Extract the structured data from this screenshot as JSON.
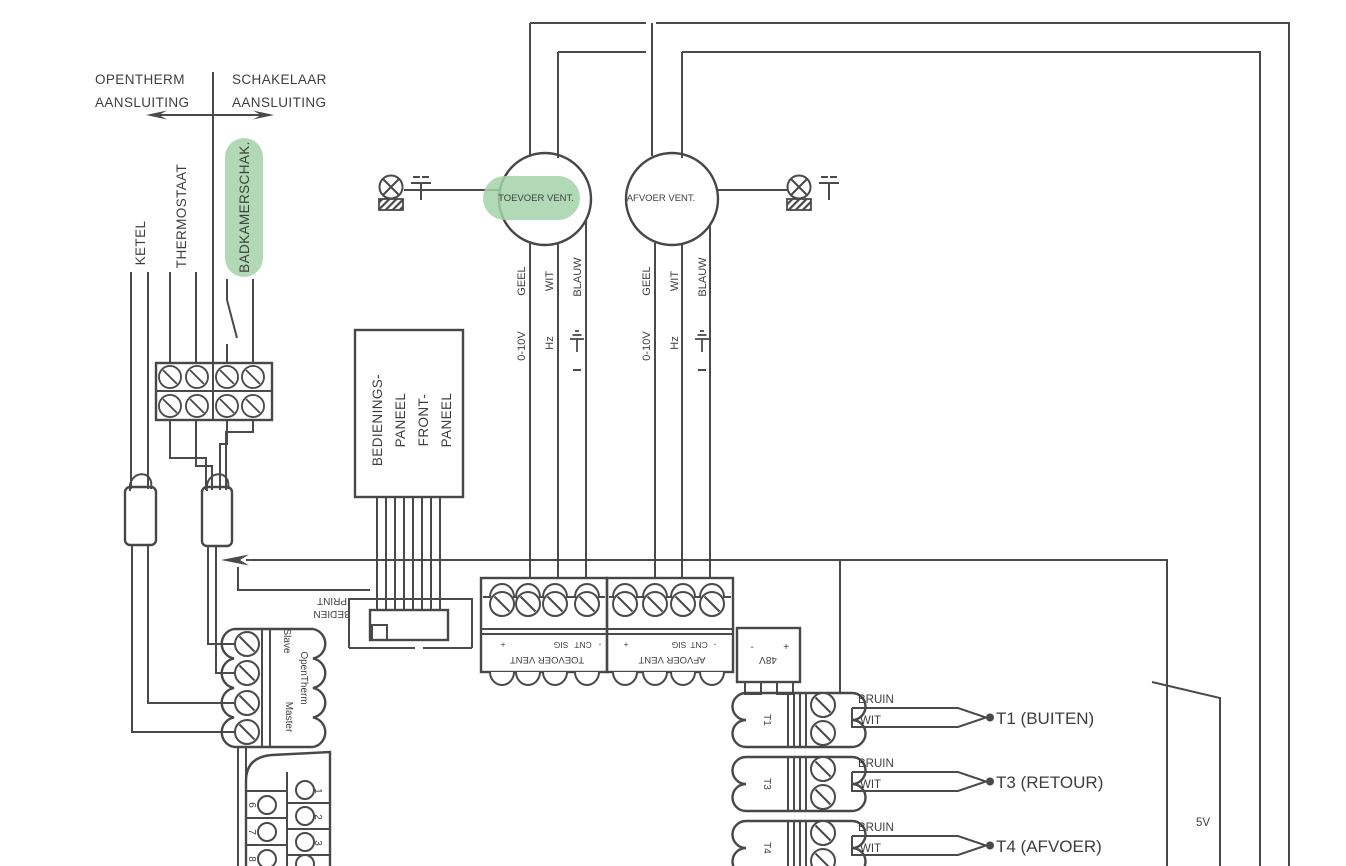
{
  "colors": {
    "line": "#4a4a4c",
    "text": "#3e3e40",
    "highlight": "#a5d2a9"
  },
  "header": {
    "left_title_line1": "OPENTHERM",
    "left_title_line2": "AANSLUITING",
    "right_title_line1": "SCHAKELAAR",
    "right_title_line2": "AANSLUITING"
  },
  "source_labels": {
    "ketel": "KETEL",
    "thermostaat": "THERMOSTAAT",
    "badkamerschak": "BADKAMERSCHAK."
  },
  "fans": {
    "supply": "TOEVOER VENT.",
    "exhaust": "AFVOER VENT."
  },
  "wire_labels": {
    "geel": "GEEL",
    "wit": "WIT",
    "blauw": "BLAUW",
    "v010": "0-10V",
    "hz": "Hz"
  },
  "panel": {
    "line1": "BEDIENINGS-",
    "line2": "PANEEL",
    "line3": "FRONT-",
    "line4": "PANEEL"
  },
  "board": {
    "line1": "BEDIEN",
    "line2": "PRINT"
  },
  "fan_terminals": {
    "plus": "+",
    "sig": "SIG",
    "cnt": "CNT",
    "minus": "-",
    "supply_name": "TOEVOER VENT",
    "exhaust_name": "AFVOER VENT"
  },
  "opentherm_block": {
    "slave": "Slave",
    "opentherm": "OpenTherm",
    "master": "Master"
  },
  "psu": {
    "minus": "-",
    "plus": "+",
    "voltage": "48V"
  },
  "sensors": [
    {
      "terminal": "T1",
      "wire_top": "BRUIN",
      "wire_bottom": "WIT",
      "label": "T1 (BUITEN)"
    },
    {
      "terminal": "T3",
      "wire_top": "BRUIN",
      "wire_bottom": "WIT",
      "label": "T3 (RETOUR)"
    },
    {
      "terminal": "T4",
      "wire_top": "BRUIN",
      "wire_bottom": "WIT",
      "label": "T4 (AFVOER)"
    }
  ],
  "supply_5v": "5V",
  "dsub": {
    "left_pins": [
      "6",
      "7",
      "8"
    ],
    "right_pins": [
      "1",
      "2",
      "3"
    ]
  }
}
